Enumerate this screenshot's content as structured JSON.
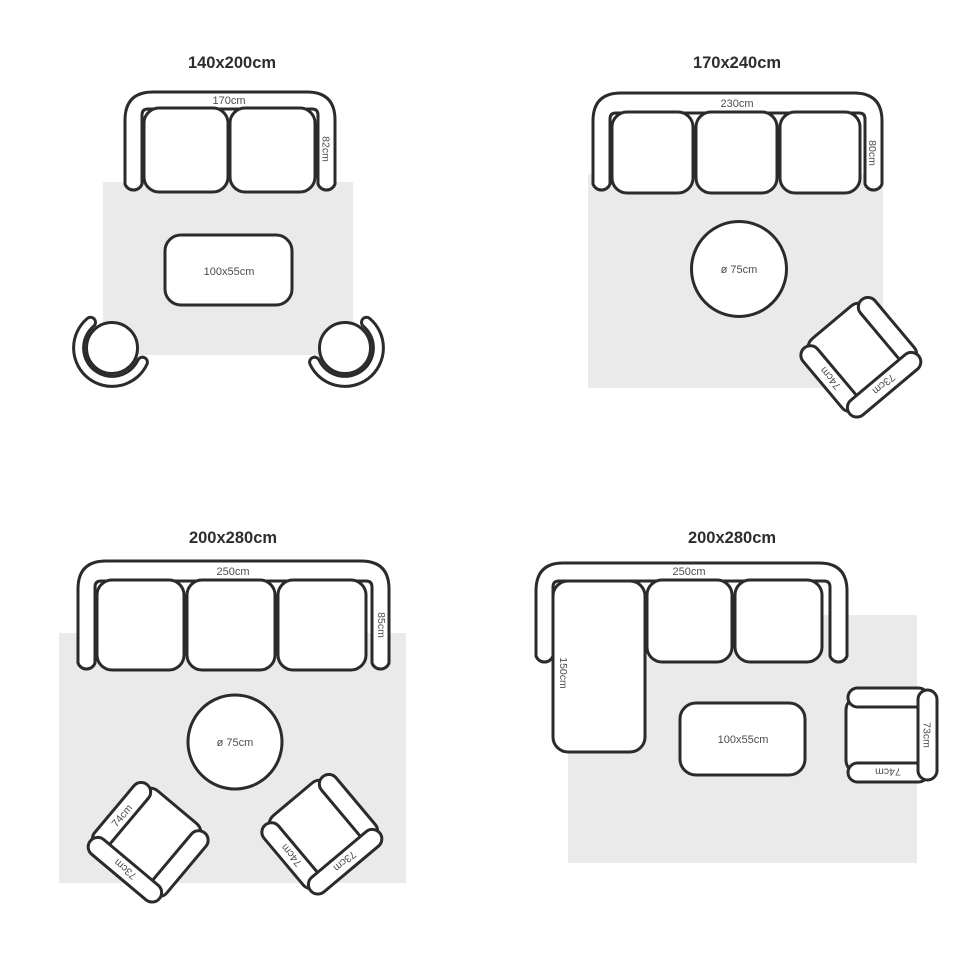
{
  "colors": {
    "background": "#ffffff",
    "line": "#2b2b2b",
    "rug": "#eaeaea",
    "label_text": "#4d4d4d",
    "title_text": "#2d2d2d"
  },
  "layouts": [
    {
      "title": "140x200cm",
      "sofa": {
        "seats": 2,
        "width_label": "170cm",
        "depth_label": "82cm"
      },
      "coffee_table": {
        "size_label": "100x55cm"
      },
      "round_chairs": 2
    },
    {
      "title": "170x240cm",
      "sofa": {
        "seats": 3,
        "width_label": "230cm",
        "depth_label": "80cm"
      },
      "round_table": {
        "size_label": "ø 75cm"
      },
      "armchairs": [
        {
          "arm_label": "74cm",
          "back_label": "73cm"
        }
      ]
    },
    {
      "title": "200x280cm",
      "sofa": {
        "seats": 3,
        "width_label": "250cm",
        "depth_label": "85cm"
      },
      "round_table": {
        "size_label": "ø 75cm"
      },
      "armchairs": [
        {
          "arm_label": "74cm",
          "back_label": "73cm"
        },
        {
          "arm_label": "74cm",
          "back_label": "73cm"
        }
      ]
    },
    {
      "title": "200x280cm",
      "sofa": {
        "seats": 2,
        "type": "corner-chaise",
        "width_label": "250cm",
        "chaise_label": "150cm"
      },
      "coffee_table": {
        "size_label": "100x55cm"
      },
      "armchairs": [
        {
          "arm_label": "74cm",
          "back_label": "73cm"
        }
      ]
    }
  ]
}
